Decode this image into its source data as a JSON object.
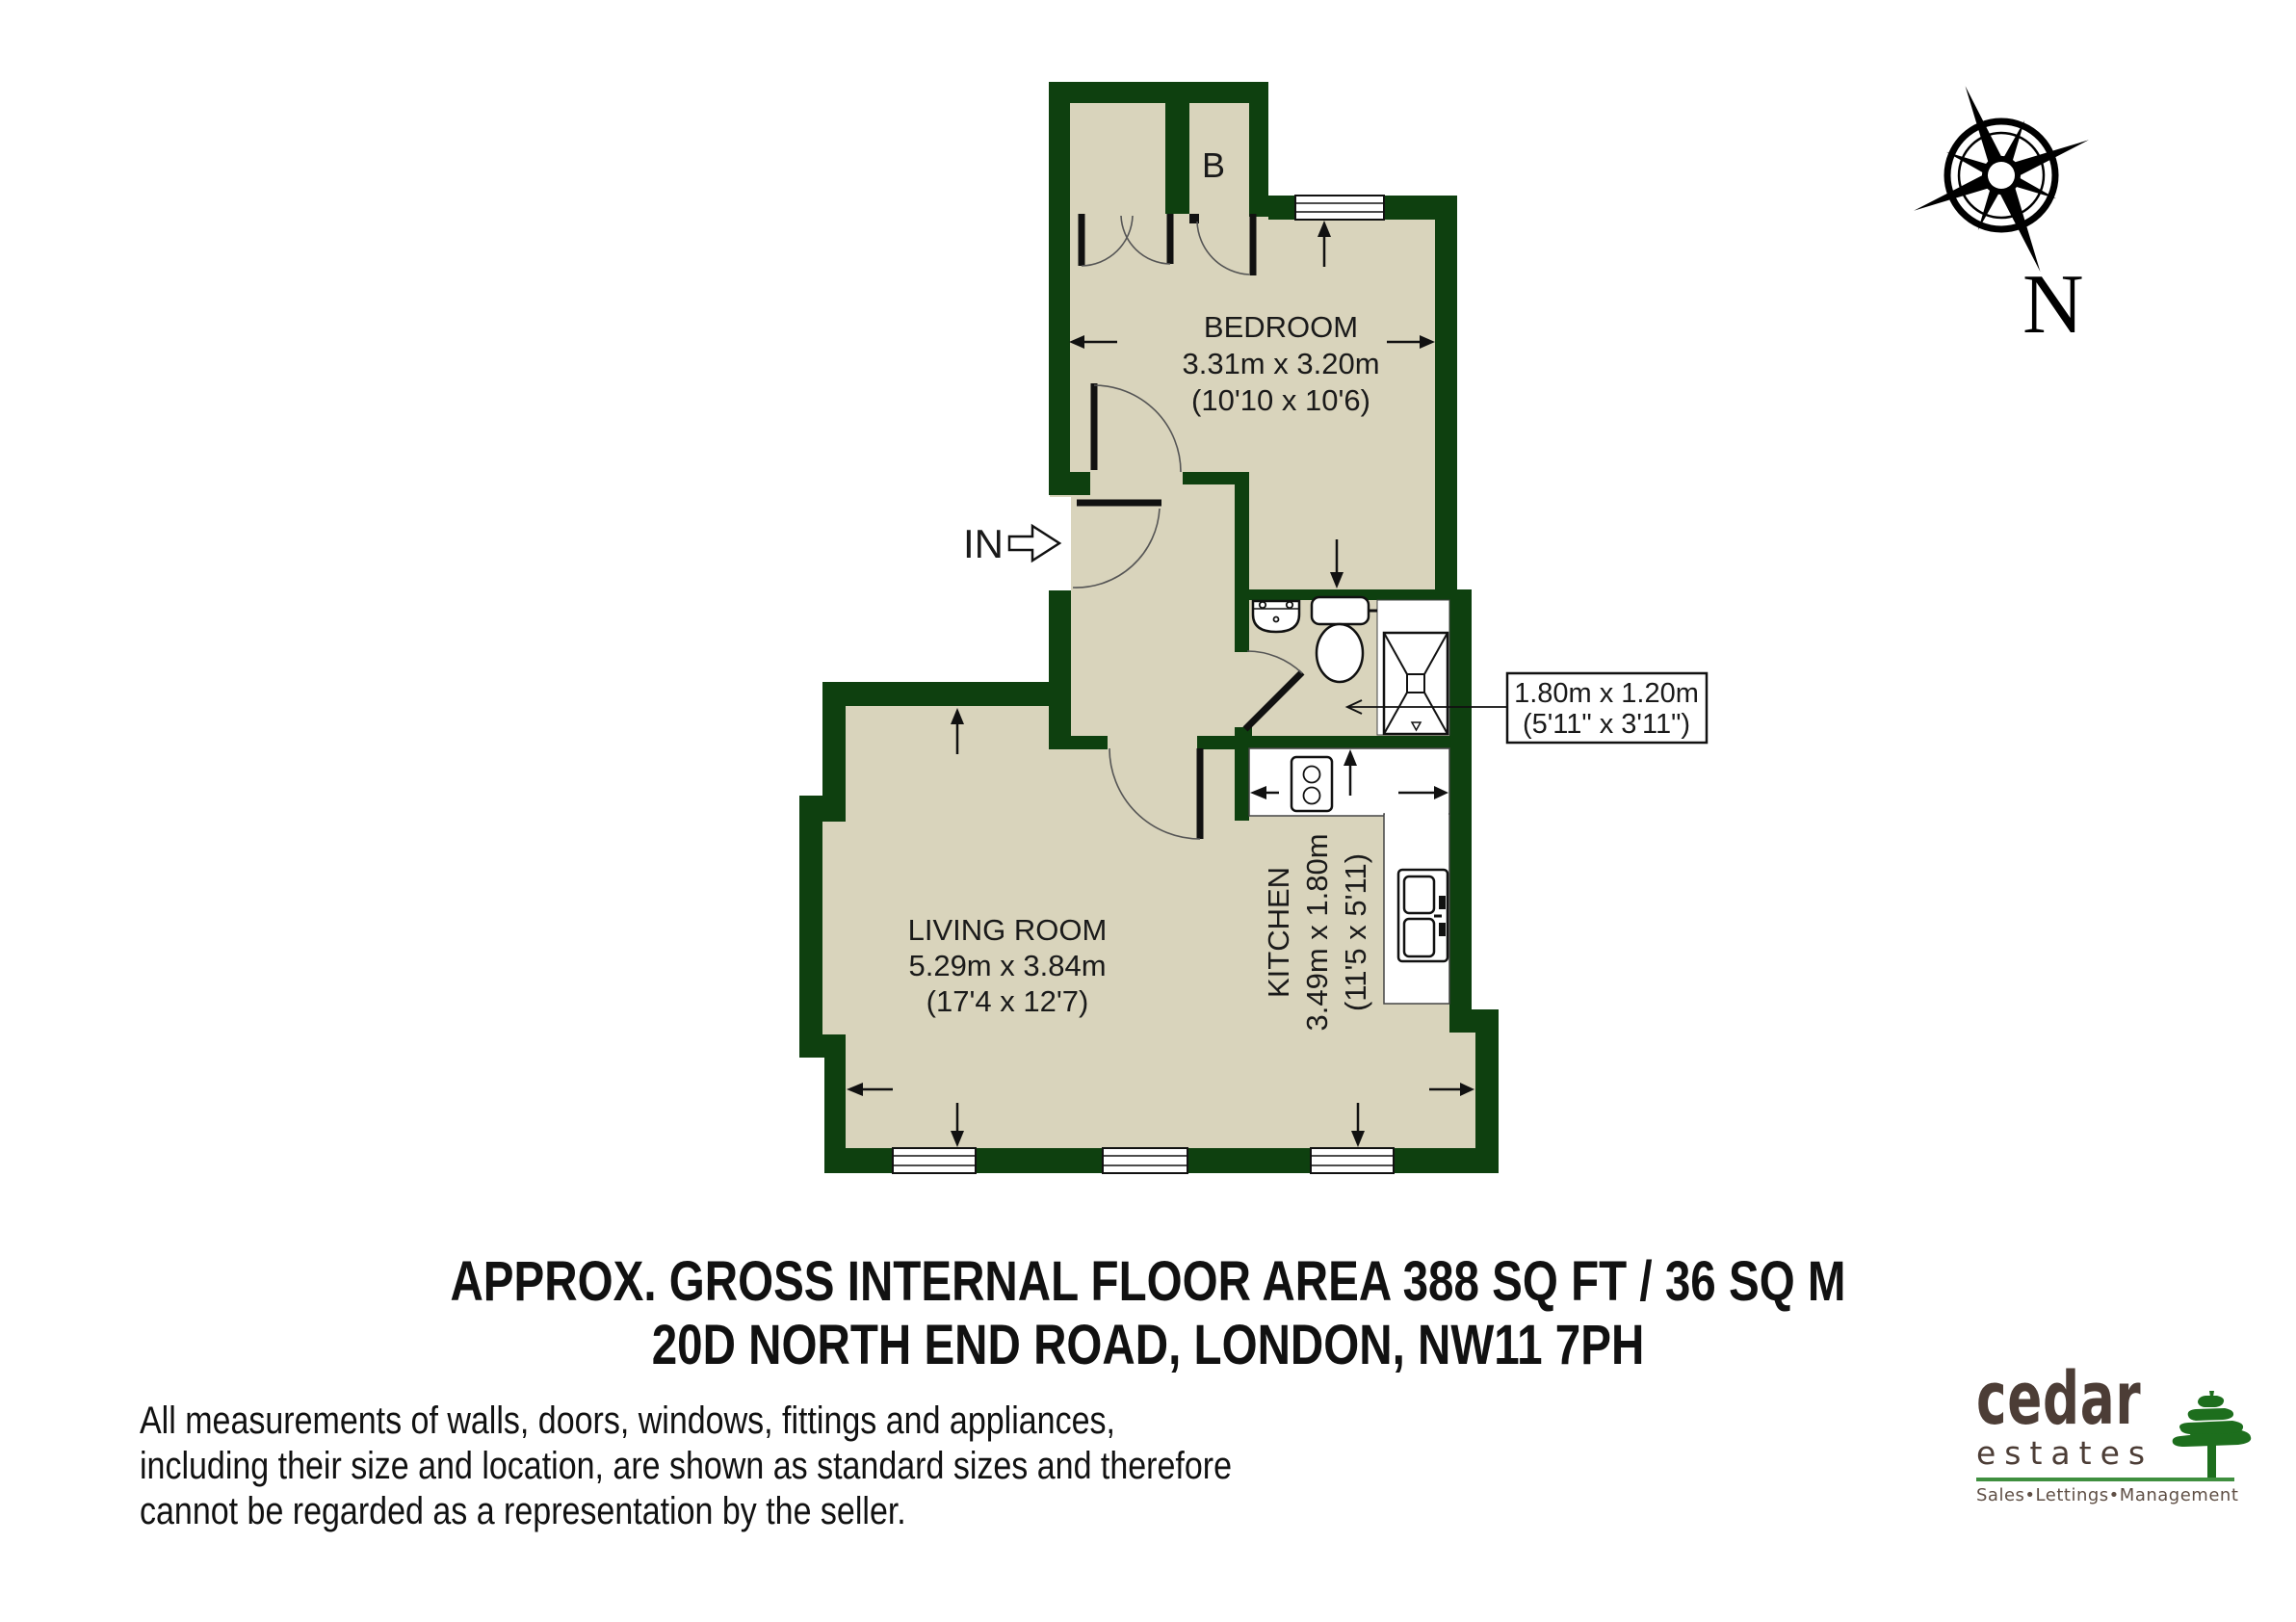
{
  "plan": {
    "entrance_label": "IN",
    "boiler_label": "B",
    "compass_label": "N",
    "rooms": {
      "bedroom": {
        "name": "BEDROOM",
        "metric": "3.31m x 3.20m",
        "imperial": "(10'10 x 10'6)"
      },
      "living_room": {
        "name": "LIVING ROOM",
        "metric": "5.29m x 3.84m",
        "imperial": "(17'4 x 12'7)"
      },
      "kitchen": {
        "name": "KITCHEN",
        "metric": "3.49m x 1.80m",
        "imperial": "(11'5 x 5'11)"
      },
      "bathroom": {
        "metric": "1.80m x 1.20m",
        "imperial": "(5'11\" x 3'11\")"
      }
    }
  },
  "summary": {
    "area_line": "APPROX. GROSS INTERNAL FLOOR AREA 388 SQ FT / 36 SQ M",
    "address_line": "20D NORTH END ROAD, LONDON, NW11 7PH"
  },
  "disclaimer": {
    "line1": "All measurements of walls, doors, windows, fittings and appliances,",
    "line2": "including their size and location, are shown as standard sizes and therefore",
    "line3": "cannot be regarded as a representation by the seller."
  },
  "logo": {
    "brand": "cedar",
    "suffix": "estates",
    "tagline_1": "Sales",
    "tagline_sep_1": "•",
    "tagline_2": "Lettings",
    "tagline_sep_2": "•",
    "tagline_3": "Management"
  },
  "colors": {
    "wall_green": "#0e400f",
    "floor_beige": "#d9d4bc",
    "logo_text_brown": "#4c3d36",
    "logo_rule_green": "#3f8f3f",
    "tree_green": "#1d6e1d"
  }
}
